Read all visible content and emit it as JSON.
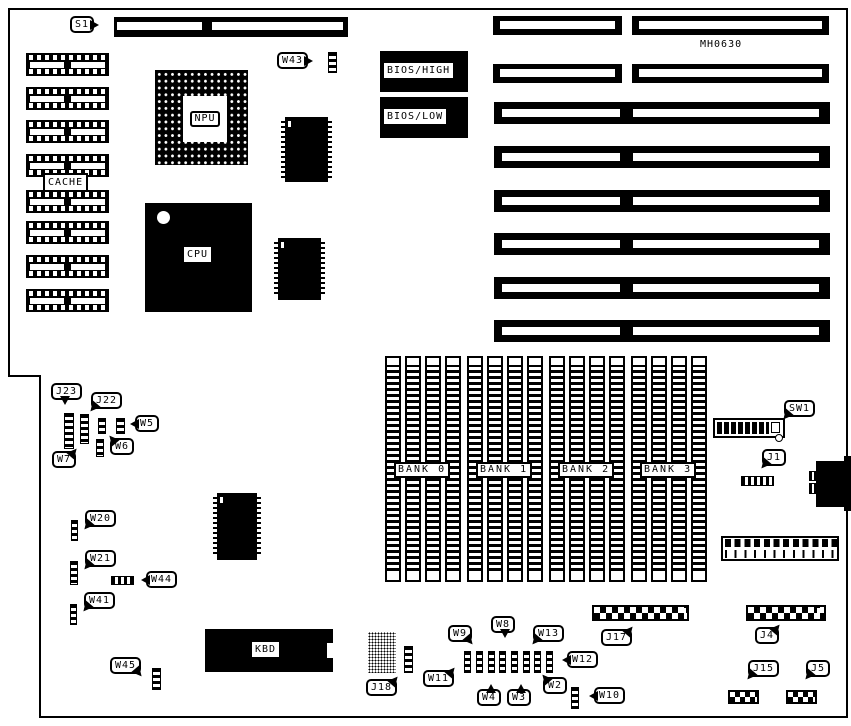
{
  "board": {
    "part_number": "MH0630"
  },
  "chips": {
    "cpu": "CPU",
    "npu": "NPU",
    "cache": "CACHE",
    "kbd": "KBD",
    "bios_high": "BIOS/HIGH",
    "bios_low": "BIOS/LOW"
  },
  "memory_banks": [
    {
      "label": "BANK 0"
    },
    {
      "label": "BANK 1"
    },
    {
      "label": "BANK 2"
    },
    {
      "label": "BANK 3"
    }
  ],
  "callouts": {
    "s1": "S1",
    "w43": "W43",
    "j23": "J23",
    "j22": "J22",
    "w5": "W5",
    "w6": "W6",
    "w7": "W7",
    "w20": "W20",
    "w21": "W21",
    "w44": "W44",
    "w41": "W41",
    "w45": "W45",
    "j18": "J18",
    "w11": "W11",
    "w9": "W9",
    "w4": "W4",
    "w8": "W8",
    "w3": "W3",
    "w13": "W13",
    "w2": "W2",
    "w12": "W12",
    "w10": "W10",
    "j17": "J17",
    "j4": "J4",
    "j15": "J15",
    "j5": "J5",
    "sw1": "SW1",
    "j1": "J1"
  },
  "colors": {
    "ink": "#000000",
    "paper": "#ffffff"
  }
}
